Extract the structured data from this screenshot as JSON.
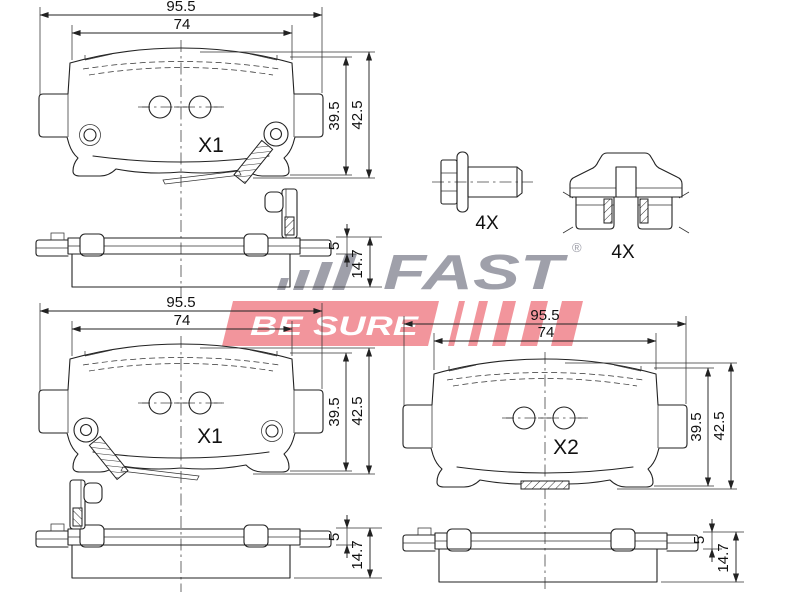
{
  "brand": {
    "wordmark": "FAST",
    "registered_mark": "®",
    "tagline": "BE SURE",
    "brand_gray": "#9FA0AA",
    "brand_red": "#F2959C"
  },
  "pad_dims": {
    "width_total": "95.5",
    "width_inner": "74",
    "height_friction": "39.5",
    "height_total": "42.5"
  },
  "side_dims": {
    "thickness_plate": "5",
    "thickness_total": "14.7"
  },
  "labels": {
    "pad_front_1": "X1",
    "pad_front_2": "X1",
    "pad_front_3": "X2",
    "bolt_qty": "4X",
    "clip_qty": "4X"
  }
}
